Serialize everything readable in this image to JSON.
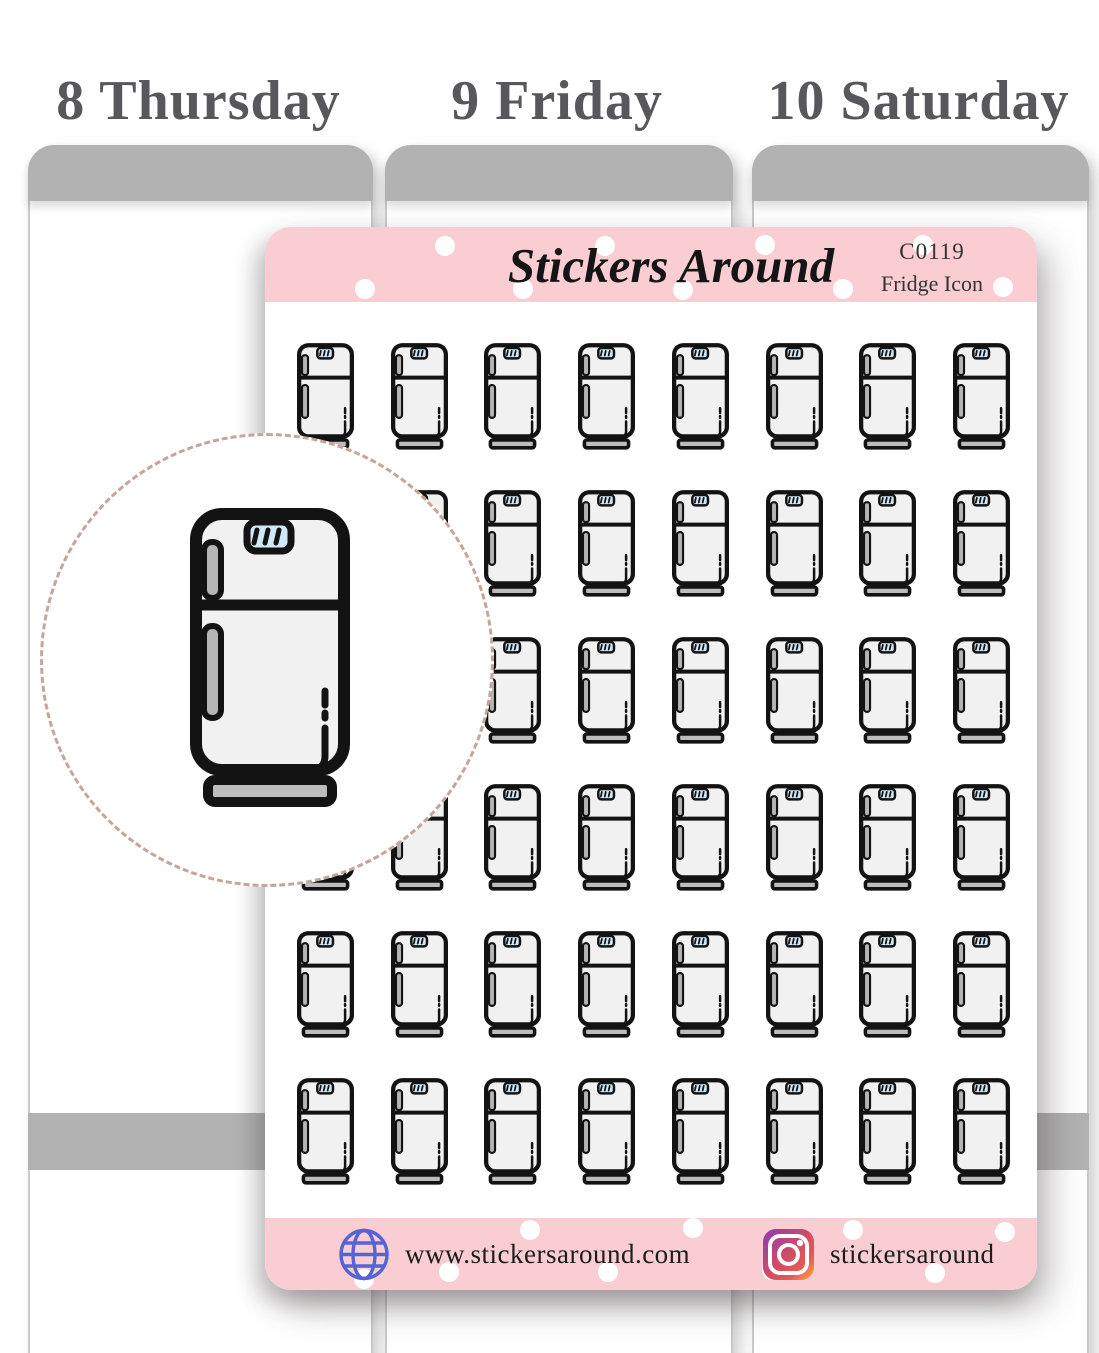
{
  "page": {
    "type": "sticker-sheet-product-photo",
    "background": "#ffffff"
  },
  "planner": {
    "day_headers": [
      "8 Thursday",
      "9 Friday",
      "10 Saturday"
    ],
    "column_header_color": "#b2b2b2"
  },
  "sticker_sheet": {
    "brand": "Stickers Around",
    "sku": "C0119",
    "product_name": "Fridge Icon",
    "band_color": "#f9cdd2",
    "grid": {
      "rows": 6,
      "columns": 8,
      "total_stickers": 48,
      "icon": "fridge-icon"
    },
    "footer": {
      "website": "www.stickersaround.com",
      "instagram_handle": "stickersaround"
    }
  },
  "zoom_preview": {
    "icon": "fridge-icon"
  },
  "colors": {
    "accent_pink": "#f9cdd2",
    "fridge_body": "#f1f1f1",
    "fridge_screen_blue": "#cfe9f7",
    "fridge_handle_gray": "#b5b5b5",
    "globe_icon_blue": "#5463d6"
  }
}
